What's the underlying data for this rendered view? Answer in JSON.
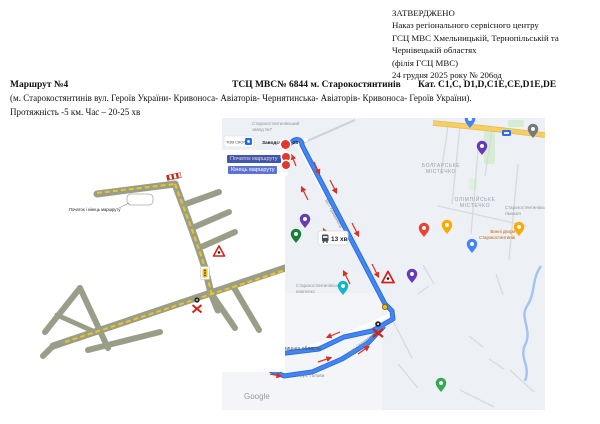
{
  "approval_block": {
    "lines": [
      "ЗАТВЕРДЖЕНО",
      "Наказ регіонального сервісного центру",
      "ГСЦ МВС Хмельницькій, Тернопільській та",
      "Чернівецькій областях",
      "(філія  ГСЦ МВС)",
      "24 грудня 2025 року № 206од"
    ]
  },
  "route_header": {
    "route_number": "Маршрут №4",
    "service_center": "ТСЦ МВС№ 6844  м. Старокостянтинів",
    "categories": "Кат.  C1,C, D1,D,C1E,CE,D1E,DE"
  },
  "route_description": "(м. Старокостянтинів вул. Героїв України- Кривоноса- Авіаторів- Чернятинська- Авіаторів- Кривоноса- Героїв України).",
  "route_params": "Протяжність -5  км.  Час – 20-25 хв",
  "schematic_map": {
    "start_end_label": "Початок і кінець маршруту"
  },
  "google_map": {
    "start_label": "Початок маршруту",
    "end_label": "Кінець маршруту",
    "time_badge": "13 хв",
    "watermark": "Google",
    "poi_address": "Заводська 8-28",
    "poi_skopi": "ТОВ СКОПІ",
    "poi_top": [
      "Старокостянтинівський",
      "завод №7"
    ],
    "district1": [
      "БОЛГАРСЬКЕ",
      "МІСТЕЧКО"
    ],
    "district2": [
      "ОЛІМПІЙСЬКЕ",
      "МІСТЕЧКО"
    ],
    "poi_school": [
      "Старокостянтинівська",
      "гімназія"
    ],
    "poi_shop": [
      "Винні двори",
      "Старокостянтинів"
    ],
    "poi_complex": [
      "Старокостянтинівський",
      "комплекс"
    ],
    "region_label": "Хмельницька область",
    "street_holovy": "вул. Голови",
    "street_along_route": "вул. Кривоноса",
    "street_west": "вул. Чернятинська"
  },
  "icons": {
    "warning_triangle": "triangle warning road sign",
    "traffic_light": "traffic light sign",
    "railway_crossing": "railway crossing sign",
    "route_flag": "start barrier flag",
    "bus": "bus transit icon",
    "map_pin": "map location pin"
  },
  "colors": {
    "route_blue": "#4285f4",
    "route_casing": "#2a6ad4",
    "route_yellow_dashed": "#f0c419",
    "schematic_road": "#999e89",
    "marker_red": "#e2372b",
    "arrow_red": "#d93025",
    "map_background": "#edf0f4",
    "main_road_yellow": "#f5cf63",
    "start_label_bg": "#3c57b4",
    "end_label_bg": "#5e72cf"
  }
}
